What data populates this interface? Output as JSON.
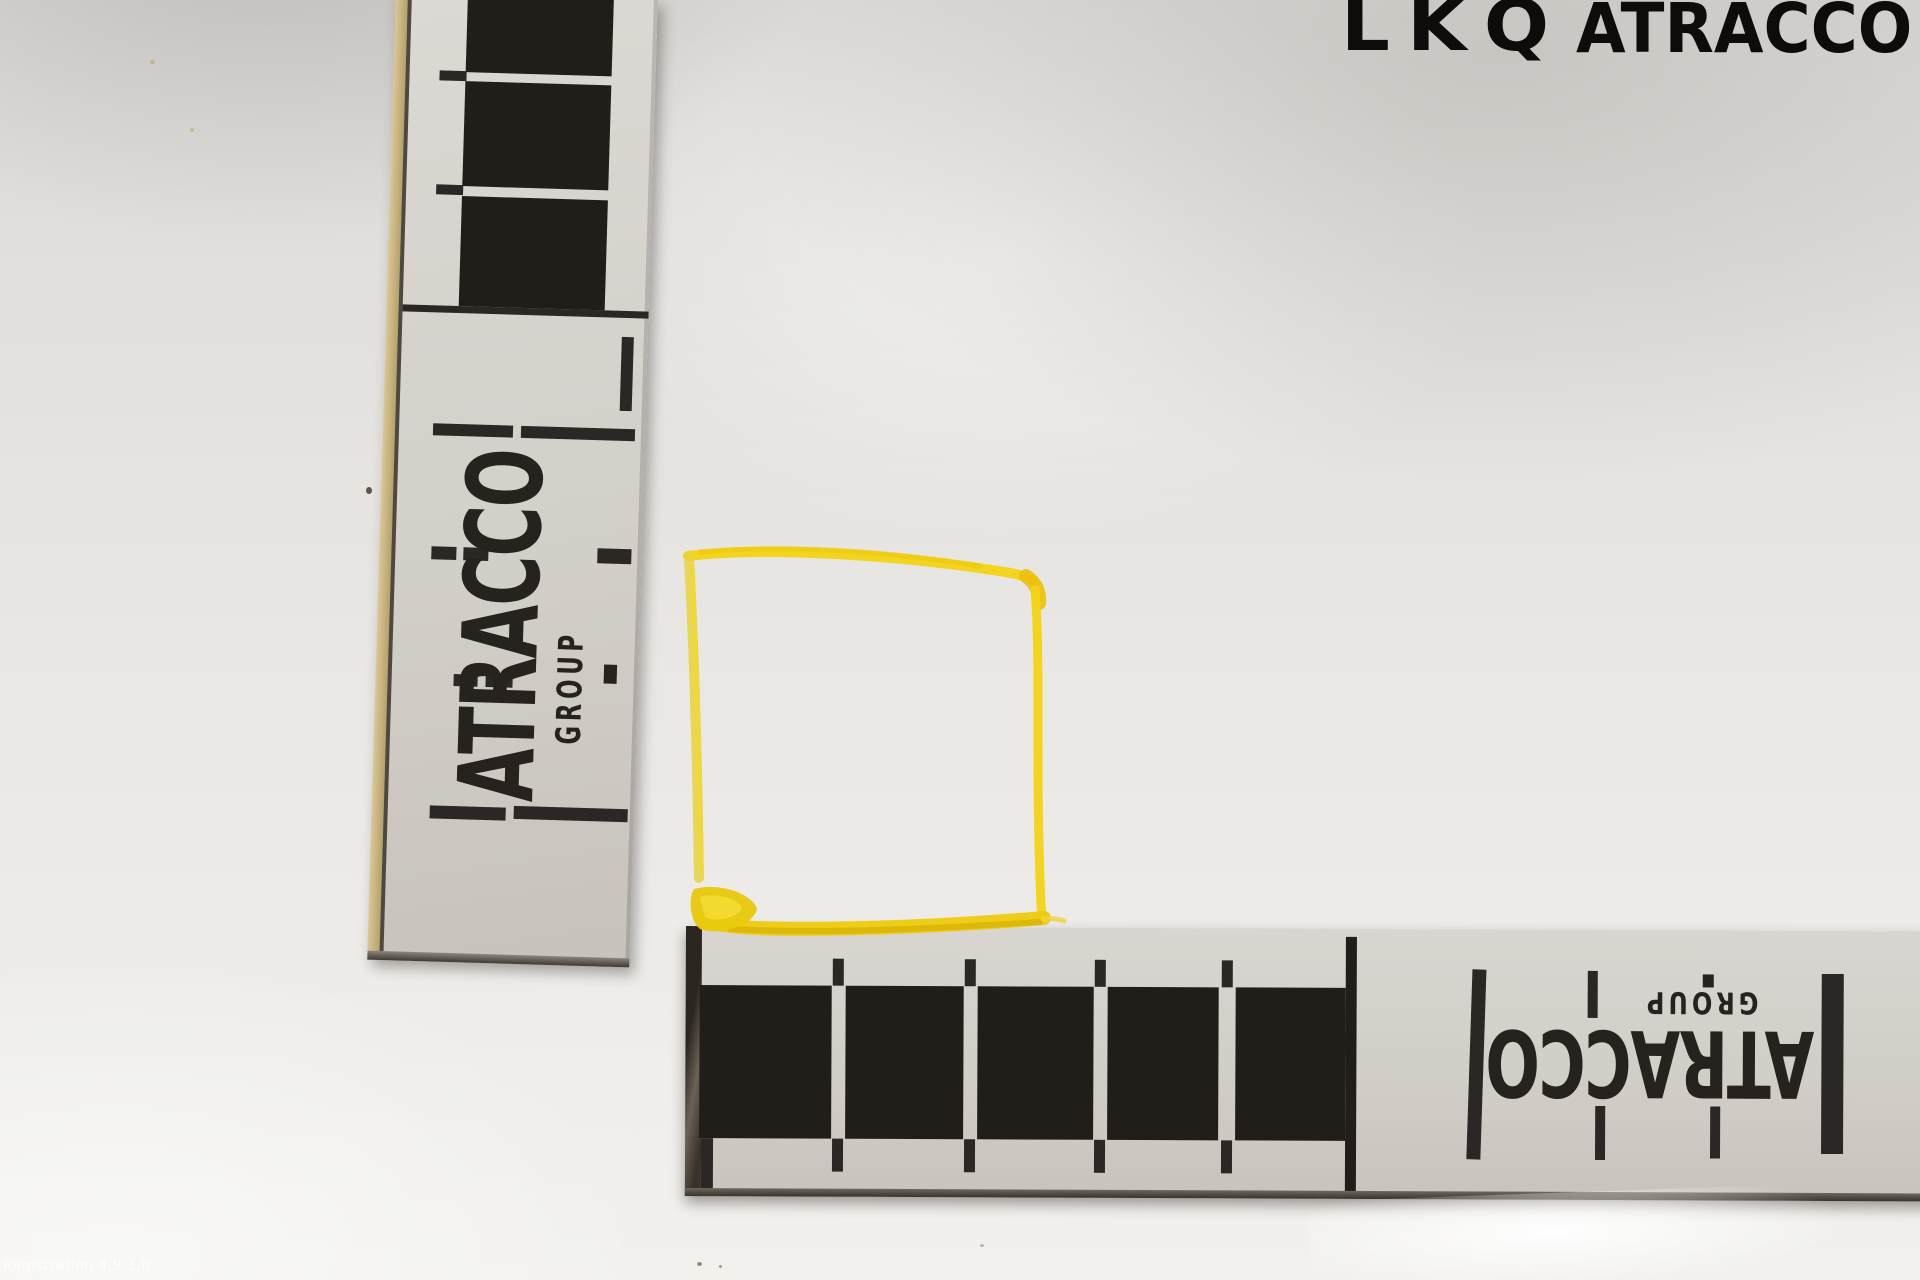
{
  "scene": {
    "description": "White panel photographed with two ATRACCO GROUP scale rulers and a hand-drawn yellow marker square",
    "surface_color": "#e9e7e4"
  },
  "logo": {
    "primary": "LKQ",
    "secondary": "ATRACCO",
    "ink": "#0d0c0b"
  },
  "vertical_ruler": {
    "brand": "ATRACCO",
    "sub_brand": "GROUP",
    "paper": "#d6d2cc",
    "ink": "#23201c"
  },
  "horizontal_ruler": {
    "brand": "ATRACCO",
    "sub_brand": "GROUP",
    "paper": "#d6d2cc",
    "ink": "#23201c"
  },
  "annotation_square": {
    "tool": "yellow-paint-marker",
    "color": "#f3d414",
    "color_dark": "#dcb808",
    "color_pale": "#e6d33c"
  },
  "watermark": {
    "text": "Registration 4.9.1.0",
    "color": "rgba(255,255,255,0.75)"
  }
}
